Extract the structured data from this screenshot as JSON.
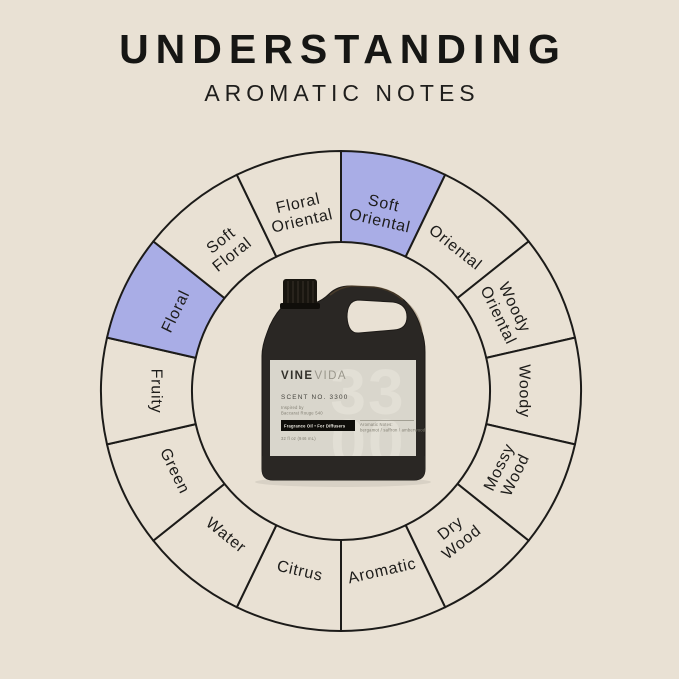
{
  "page": {
    "background": "#e9e1d4"
  },
  "header": {
    "title": "UNDERSTANDING",
    "subtitle": "AROMATIC NOTES"
  },
  "wheel": {
    "outline_color": "#1c1b19",
    "base_fill": "#e9e1d4",
    "highlight_fill": "#a9ade6",
    "text_color": "#1d1c1a",
    "segments": [
      {
        "label": "Soft Oriental",
        "lines": [
          "Soft",
          "Oriental"
        ],
        "highlighted": true
      },
      {
        "label": "Oriental",
        "lines": [
          "Oriental"
        ],
        "highlighted": false
      },
      {
        "label": "Woody Oriental",
        "lines": [
          "Woody",
          "Oriental"
        ],
        "highlighted": false
      },
      {
        "label": "Woody",
        "lines": [
          "Woody"
        ],
        "highlighted": false
      },
      {
        "label": "Mossy Wood",
        "lines": [
          "Mossy",
          "Wood"
        ],
        "highlighted": false
      },
      {
        "label": "Dry Wood",
        "lines": [
          "Dry",
          "Wood"
        ],
        "highlighted": false
      },
      {
        "label": "Aromatic",
        "lines": [
          "Aromatic"
        ],
        "highlighted": false
      },
      {
        "label": "Citrus",
        "lines": [
          "Citrus"
        ],
        "highlighted": false
      },
      {
        "label": "Water",
        "lines": [
          "Water"
        ],
        "highlighted": false
      },
      {
        "label": "Green",
        "lines": [
          "Green"
        ],
        "highlighted": false
      },
      {
        "label": "Fruity",
        "lines": [
          "Fruity"
        ],
        "highlighted": false
      },
      {
        "label": "Floral",
        "lines": [
          "Floral"
        ],
        "highlighted": true
      },
      {
        "label": "Soft Floral",
        "lines": [
          "Soft",
          "Floral"
        ],
        "highlighted": false
      },
      {
        "label": "Floral Oriental",
        "lines": [
          "Floral",
          "Oriental"
        ],
        "highlighted": false
      }
    ]
  },
  "bottle": {
    "brand_bold": "VINE",
    "brand_light": "VIDA",
    "scent_no": "SCENT NO. 3300",
    "inspired_line1": "Inspired by",
    "inspired_line2": "Baccarat Rouge 540",
    "badge": "Fragrance Oil • For Diffusers",
    "notes_label": "Aromatic Notes:",
    "notes_value": "bergamot / saffron / amberwood",
    "size_text": "32 fl oz (946 mL)",
    "watermark_top": "33",
    "watermark_bottom": "00"
  }
}
